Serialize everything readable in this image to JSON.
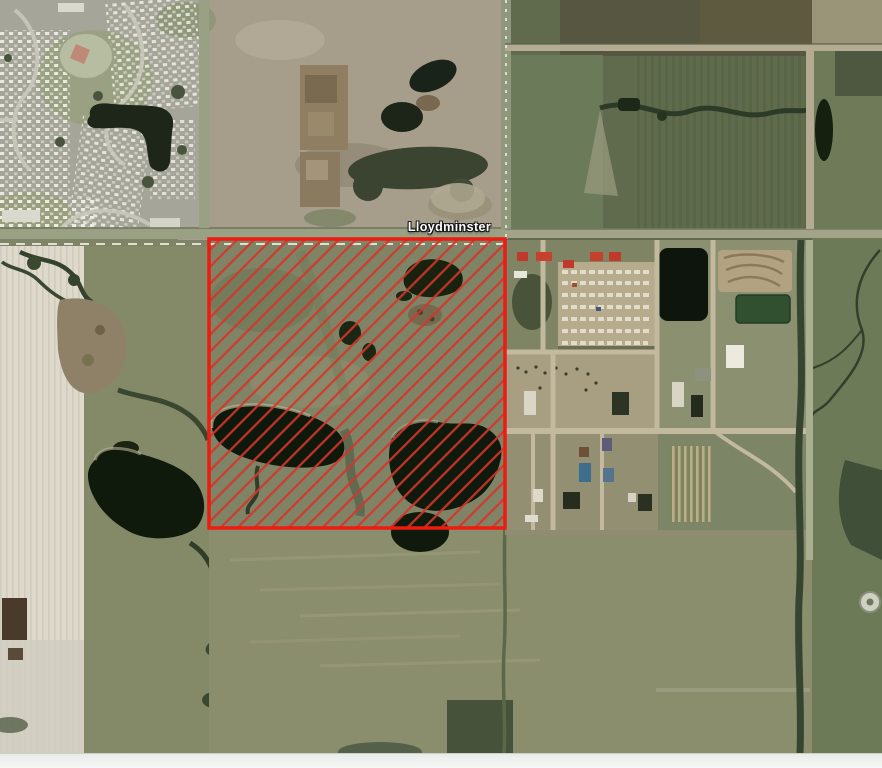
{
  "map": {
    "boundary_label": "Lloydminster",
    "parcel": {
      "shape": "rectangle",
      "x": 209,
      "y": 239,
      "width": 296,
      "height": 289,
      "outline_color": "#ee1b10",
      "hatch_color": "#d5352a",
      "hatch_style": "diagonal-forward-slash"
    },
    "boundary_dash_color": "#eeeee4",
    "bottom_bar_color": "#f2f4f1",
    "industrial_buildings": [
      {
        "name": "red-roof-warehouse",
        "x": 517,
        "y": 252,
        "w": 11,
        "h": 9,
        "fill": "#c0392a"
      },
      {
        "name": "red-roof-warehouse",
        "x": 536,
        "y": 252,
        "w": 16,
        "h": 9,
        "fill": "#c6402e"
      },
      {
        "name": "red-roof-warehouse",
        "x": 563,
        "y": 260,
        "w": 11,
        "h": 8,
        "fill": "#c0392a"
      },
      {
        "name": "red-roof-warehouse",
        "x": 590,
        "y": 252,
        "w": 13,
        "h": 9,
        "fill": "#c6402e"
      },
      {
        "name": "red-roof-warehouse",
        "x": 609,
        "y": 252,
        "w": 12,
        "h": 9,
        "fill": "#c0392a"
      },
      {
        "name": "white-building",
        "x": 514,
        "y": 271,
        "w": 13,
        "h": 7,
        "fill": "#e6e6da"
      },
      {
        "name": "white-warehouse",
        "x": 726,
        "y": 345,
        "w": 18,
        "h": 23,
        "fill": "#eceade"
      },
      {
        "name": "white-shed",
        "x": 524,
        "y": 391,
        "w": 12,
        "h": 24,
        "fill": "#dad6c6"
      },
      {
        "name": "dark-building",
        "x": 612,
        "y": 392,
        "w": 17,
        "h": 23,
        "fill": "#2c3424"
      },
      {
        "name": "white-shed",
        "x": 672,
        "y": 382,
        "w": 12,
        "h": 25,
        "fill": "#d9d5c5"
      },
      {
        "name": "dark-shed",
        "x": 691,
        "y": 395,
        "w": 12,
        "h": 22,
        "fill": "#242b1d"
      },
      {
        "name": "purple-shed",
        "x": 602,
        "y": 438,
        "w": 10,
        "h": 13,
        "fill": "#5d5c7a"
      },
      {
        "name": "blue-building",
        "x": 579,
        "y": 463,
        "w": 12,
        "h": 19,
        "fill": "#3e6d8e"
      },
      {
        "name": "blue-shed",
        "x": 603,
        "y": 468,
        "w": 11,
        "h": 14,
        "fill": "#56738e"
      },
      {
        "name": "brown-shed",
        "x": 579,
        "y": 447,
        "w": 10,
        "h": 10,
        "fill": "#6e5038"
      },
      {
        "name": "white-shed",
        "x": 533,
        "y": 489,
        "w": 10,
        "h": 13,
        "fill": "#ded9c9"
      },
      {
        "name": "dark-building",
        "x": 563,
        "y": 492,
        "w": 17,
        "h": 17,
        "fill": "#262d1f"
      },
      {
        "name": "white-shed",
        "x": 525,
        "y": 515,
        "w": 13,
        "h": 7,
        "fill": "#e0dccd"
      },
      {
        "name": "white-shed",
        "x": 628,
        "y": 493,
        "w": 8,
        "h": 9,
        "fill": "#d8d4c4"
      },
      {
        "name": "dark-building",
        "x": 638,
        "y": 494,
        "w": 14,
        "h": 17,
        "fill": "#2a3122"
      },
      {
        "name": "gray-tank-pad",
        "x": 695,
        "y": 368,
        "w": 16,
        "h": 13,
        "fill": "#8d927f"
      }
    ]
  }
}
